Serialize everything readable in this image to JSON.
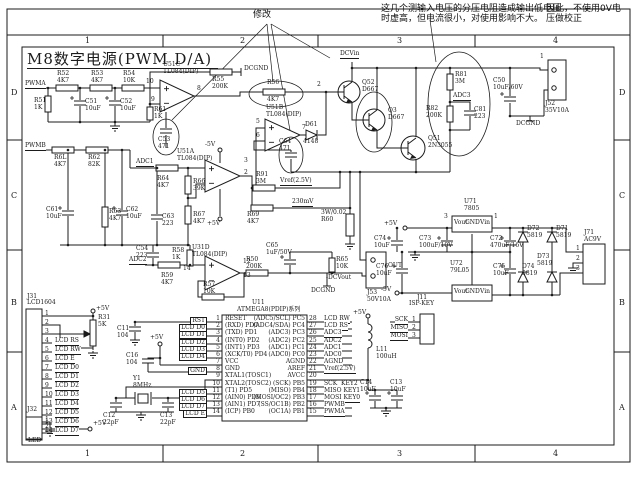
{
  "title": "M8数字电源(PWM D/A)",
  "frame": {
    "columns": [
      "1",
      "2",
      "3",
      "4"
    ],
    "rows": [
      "D",
      "C",
      "B",
      "A"
    ]
  },
  "notes": {
    "revision_mark": "修改",
    "note_line1": "这几个测输入电压的分压电阻造成输出低电压",
    "note_line2": "时虚高，但电流很小，对使用影响不大。",
    "note_right_line1": "因此，不使用0V电",
    "note_right_line2": "压做校正"
  },
  "components": [
    {
      "r": "R52",
      "v": "4K7",
      "x": 57,
      "y": 71
    },
    {
      "r": "R53",
      "v": "4K7",
      "x": 91,
      "y": 71
    },
    {
      "r": "R54",
      "v": "10K",
      "x": 123,
      "y": 71
    },
    {
      "r": "R51",
      "v": "1K",
      "x": 34,
      "y": 98
    },
    {
      "r": "C51",
      "v": "10uF",
      "x": 85,
      "y": 99
    },
    {
      "r": "C52",
      "v": "10uF",
      "x": 120,
      "y": 99
    },
    {
      "r": "R61",
      "v": "1K",
      "x": 154,
      "y": 107
    },
    {
      "r": "R55",
      "v": "200K",
      "x": 212,
      "y": 77
    },
    {
      "r": "U51C",
      "v": "TL084(DIP)",
      "x": 163,
      "y": 62
    },
    {
      "r": "U51B",
      "v": "TL084(DIP)",
      "x": 266,
      "y": 105
    },
    {
      "r": "C53",
      "v": "471",
      "x": 158,
      "y": 137
    },
    {
      "r": "C64",
      "v": "471",
      "x": 279,
      "y": 139
    },
    {
      "r": "Q52",
      "v": "D667",
      "x": 362,
      "y": 80
    },
    {
      "r": "Q3",
      "v": "D667",
      "x": 388,
      "y": 108
    },
    {
      "r": "Q51",
      "v": "2N3055",
      "x": 428,
      "y": 136
    },
    {
      "r": "R81",
      "v": "3M",
      "x": 455,
      "y": 72
    },
    {
      "r": "R82",
      "v": "200K",
      "x": 426,
      "y": 106
    },
    {
      "r": "C81",
      "v": "223",
      "x": 474,
      "y": 107
    },
    {
      "r": "C50",
      "v": "10uF/60V",
      "x": 493,
      "y": 78
    },
    {
      "r": "J52",
      "v": "35V10A",
      "x": 545,
      "y": 101
    },
    {
      "r": "R6L",
      "v": "4K7",
      "x": 54,
      "y": 155
    },
    {
      "r": "R62",
      "v": "82K",
      "x": 88,
      "y": 155
    },
    {
      "r": "C61",
      "v": "10uF",
      "x": 46,
      "y": 207
    },
    {
      "r": "R63",
      "v": "4K7",
      "x": 109,
      "y": 209
    },
    {
      "r": "C62",
      "v": "10uF",
      "x": 126,
      "y": 207
    },
    {
      "r": "U51A",
      "v": "TL084(DIP)",
      "x": 177,
      "y": 149
    },
    {
      "r": "R64",
      "v": "4K7",
      "x": 157,
      "y": 176
    },
    {
      "r": "R66",
      "v": "39K",
      "x": 193,
      "y": 179
    },
    {
      "r": "C63",
      "v": "223",
      "x": 162,
      "y": 214
    },
    {
      "r": "R67",
      "v": "4K7",
      "x": 193,
      "y": 212
    },
    {
      "r": "R91",
      "v": "3M",
      "x": 256,
      "y": 172
    },
    {
      "r": "R69",
      "v": "4K7",
      "x": 247,
      "y": 212
    },
    {
      "r": "C54",
      "v": "223",
      "x": 136,
      "y": 246
    },
    {
      "r": "R58",
      "v": "1K",
      "x": 172,
      "y": 248
    },
    {
      "r": "R59",
      "v": "4K7",
      "x": 161,
      "y": 273
    },
    {
      "r": "U31D",
      "v": "TL084(DIP)",
      "x": 192,
      "y": 245
    },
    {
      "r": "R57",
      "v": "10K",
      "x": 203,
      "y": 282
    },
    {
      "r": "R50",
      "v": "200K",
      "x": 246,
      "y": 257
    },
    {
      "r": "C65",
      "v": "1uF/50V",
      "x": 266,
      "y": 243
    },
    {
      "r": "R65",
      "v": "10K",
      "x": 336,
      "y": 257
    },
    {
      "r": "3W/0.02",
      "v": "R60",
      "x": 321,
      "y": 210
    },
    {
      "r": "J53",
      "v": "50V10A",
      "x": 367,
      "y": 290
    },
    {
      "r": "U71",
      "v": "7805",
      "x": 464,
      "y": 199
    },
    {
      "r": "U72",
      "v": "79L05",
      "x": 450,
      "y": 261
    },
    {
      "r": "C74",
      "v": "10uF",
      "x": 374,
      "y": 236
    },
    {
      "r": "C73",
      "v": "100uF/10V",
      "x": 419,
      "y": 236
    },
    {
      "r": "C72",
      "v": "470uF/16V",
      "x": 490,
      "y": 236
    },
    {
      "r": "C76",
      "v": "10uF",
      "x": 376,
      "y": 264
    },
    {
      "r": "C75",
      "v": "10uF",
      "x": 493,
      "y": 264
    },
    {
      "r": "D72",
      "v": "5819",
      "x": 527,
      "y": 226
    },
    {
      "r": "D71",
      "v": "5819",
      "x": 556,
      "y": 226
    },
    {
      "r": "D73",
      "v": "5819",
      "x": 537,
      "y": 254
    },
    {
      "r": "D74",
      "v": "5819",
      "x": 522,
      "y": 264
    },
    {
      "r": "J71",
      "v": "AC9V",
      "x": 584,
      "y": 230
    },
    {
      "r": "Y1",
      "v": "8MHz",
      "x": 133,
      "y": 376
    },
    {
      "r": "C12",
      "v": "22pF",
      "x": 103,
      "y": 413
    },
    {
      "r": "C13",
      "v": "22pF",
      "x": 160,
      "y": 413
    },
    {
      "r": "C11",
      "v": "104",
      "x": 117,
      "y": 326
    },
    {
      "r": "C16",
      "v": "104",
      "x": 126,
      "y": 353
    },
    {
      "r": "R31",
      "v": "5K",
      "x": 98,
      "y": 315
    },
    {
      "r": "R32",
      "v": "10",
      "x": 64,
      "y": 409
    },
    {
      "r": "L11",
      "v": "100uH",
      "x": 376,
      "y": 347
    },
    {
      "r": "C14",
      "v": "10uF",
      "x": 360,
      "y": 380
    },
    {
      "r": "C13",
      "v": "10uF",
      "x": 390,
      "y": 380
    }
  ],
  "net_labels": [
    {
      "t": "PWMA",
      "x": 25,
      "y": 81,
      "u": 1
    },
    {
      "t": "PWMB",
      "x": 25,
      "y": 143,
      "u": 1
    },
    {
      "t": "DCGND",
      "x": 244,
      "y": 66
    },
    {
      "t": "10",
      "x": 146,
      "y": 79
    },
    {
      "t": "9",
      "x": 151,
      "y": 97
    },
    {
      "t": "8",
      "x": 197,
      "y": 86
    },
    {
      "t": "R56",
      "x": 267,
      "y": 80
    },
    {
      "t": "4K7",
      "x": 267,
      "y": 97
    },
    {
      "t": "2",
      "x": 317,
      "y": 82
    },
    {
      "t": "5",
      "x": 256,
      "y": 119
    },
    {
      "t": "6",
      "x": 256,
      "y": 133
    },
    {
      "t": "7",
      "x": 302,
      "y": 125
    },
    {
      "t": "D61",
      "x": 305,
      "y": 122
    },
    {
      "t": "4148",
      "x": 303,
      "y": 139
    },
    {
      "t": "DCVin",
      "x": 340,
      "y": 51,
      "u": 1
    },
    {
      "t": "ADC3",
      "x": 453,
      "y": 93,
      "u": 1
    },
    {
      "t": "1",
      "x": 540,
      "y": 54
    },
    {
      "t": "DCGND",
      "x": 516,
      "y": 121
    },
    {
      "t": "ADC1",
      "x": 136,
      "y": 159,
      "u": 1
    },
    {
      "t": "-5V",
      "x": 205,
      "y": 142
    },
    {
      "t": "+5V",
      "x": 207,
      "y": 221
    },
    {
      "t": "3",
      "x": 244,
      "y": 158
    },
    {
      "t": "2",
      "x": 244,
      "y": 170
    },
    {
      "t": "Vref(2.5V)",
      "x": 280,
      "y": 178,
      "u": 1
    },
    {
      "t": "230mV",
      "x": 292,
      "y": 199,
      "u": 1
    },
    {
      "t": "ADC2",
      "x": 129,
      "y": 257,
      "u": 1
    },
    {
      "t": "12",
      "x": 243,
      "y": 259
    },
    {
      "t": "13",
      "x": 243,
      "y": 273
    },
    {
      "t": "14",
      "x": 183,
      "y": 266
    },
    {
      "t": "OUT",
      "x": 388,
      "y": 263
    },
    {
      "t": "-DCVout",
      "x": 326,
      "y": 275
    },
    {
      "t": "DCGND",
      "x": 311,
      "y": 288
    },
    {
      "t": "+5V",
      "x": 384,
      "y": 221
    },
    {
      "t": "3",
      "x": 444,
      "y": 214
    },
    {
      "t": "1",
      "x": 494,
      "y": 214
    },
    {
      "t": "-5V",
      "x": 381,
      "y": 287
    },
    {
      "t": "1",
      "x": 576,
      "y": 246
    },
    {
      "t": "2",
      "x": 576,
      "y": 256
    },
    {
      "t": "3",
      "x": 576,
      "y": 266
    },
    {
      "t": "Vout",
      "x": 454,
      "y": 220
    },
    {
      "t": "GND",
      "x": 465,
      "y": 220
    },
    {
      "t": "Vin",
      "x": 480,
      "y": 220
    },
    {
      "t": "Vout",
      "x": 454,
      "y": 289
    },
    {
      "t": "GND",
      "x": 465,
      "y": 289
    },
    {
      "t": "Vin",
      "x": 480,
      "y": 289
    },
    {
      "t": "+5V",
      "x": 150,
      "y": 335
    },
    {
      "t": "+5V",
      "x": 96,
      "y": 306
    },
    {
      "t": "+5V",
      "x": 93,
      "y": 421
    },
    {
      "t": "+5V",
      "x": 353,
      "y": 310
    }
  ],
  "mcu": {
    "ref": "U11",
    "part": "ATMEGA8(PDIP)系列",
    "rows": [
      {
        "ll": "RST",
        "lp": "1",
        "l": "RESET",
        "r": "(ADC5/SCL) PC5",
        "rp": "28",
        "rl": "LCD RW"
      },
      {
        "ll": "LCD D0",
        "lp": "2",
        "l": "(RXD) PD0",
        "r": "(ADC4/SDA) PC4",
        "rp": "27",
        "rl": "LCD RS"
      },
      {
        "ll": "LCD D1",
        "lp": "3",
        "l": "(TXD) PD1",
        "r": "(ADC3) PC3",
        "rp": "26",
        "rl": "ADC3"
      },
      {
        "ll": "LCD D2",
        "lp": "4",
        "l": "(INT0) PD2",
        "r": "(ADC2) PC2",
        "rp": "25",
        "rl": "ADC2"
      },
      {
        "ll": "LCD D3",
        "lp": "5",
        "l": "(INT1) PD3",
        "r": "(ADC1) PC1",
        "rp": "24",
        "rl": "ADC1"
      },
      {
        "ll": "LCD D4",
        "lp": "6",
        "l": "(XCK/T0) PD4",
        "r": "(ADC0) PC0",
        "rp": "23",
        "rl": "ADC0"
      },
      {
        "ll": "",
        "lp": "7",
        "l": "VCC",
        "r": "AGND",
        "rp": "22",
        "rl": "AGND"
      },
      {
        "ll": "GND",
        "lp": "8",
        "l": "GND",
        "r": "AREF",
        "rp": "21",
        "rl": "Vref(2.5V)"
      },
      {
        "ll": "",
        "lp": "9",
        "l": "XTAL1(TOSC1)",
        "r": "AVCC",
        "rp": "20",
        "rl": ""
      },
      {
        "ll": "",
        "lp": "10",
        "l": "XTAL2(TOSC2)",
        "r": "(SCK) PB5",
        "rp": "19",
        "rl": "SCK  KEY2"
      },
      {
        "ll": "LCD D5",
        "lp": "11",
        "l": "(T1) PD5",
        "r": "(MISO) PB4",
        "rp": "18",
        "rl": "MISO KEY1"
      },
      {
        "ll": "LCD D6",
        "lp": "12",
        "l": "(AIN0) PD6",
        "r": "(MOSI/OC2) PB3",
        "rp": "17",
        "rl": "MOSI KEY0"
      },
      {
        "ll": "LCD D7",
        "lp": "13",
        "l": "(AIN1) PD7",
        "r": "(SS/OC1B) PB2",
        "rp": "16",
        "rl": "PWMB"
      },
      {
        "ll": "LCD E",
        "lp": "14",
        "l": "(ICP) PB0",
        "r": "(OC1A) PB1",
        "rp": "15",
        "rl": "PWMA"
      }
    ]
  },
  "lcd_connector": {
    "ref": "J31",
    "part": "LCD1604",
    "pins": [
      {
        "n": "1",
        "t": ""
      },
      {
        "n": "2",
        "t": ""
      },
      {
        "n": "3",
        "t": ""
      },
      {
        "n": "4",
        "t": "LCD RS"
      },
      {
        "n": "5",
        "t": "LCD RW"
      },
      {
        "n": "6",
        "t": "LCD E"
      },
      {
        "n": "7",
        "t": "LCD D0"
      },
      {
        "n": "8",
        "t": "LCD D1"
      },
      {
        "n": "9",
        "t": "LCD D2"
      },
      {
        "n": "10",
        "t": "LCD D3"
      },
      {
        "n": "11",
        "t": "LCD D4"
      },
      {
        "n": "12",
        "t": "LCD D5"
      },
      {
        "n": "13",
        "t": "LCD D6"
      },
      {
        "n": "14",
        "t": "LCD D7"
      }
    ]
  },
  "isp_connector": {
    "ref": "J11",
    "part": "ISP-KEY",
    "pins": [
      {
        "n": "1",
        "t": "SCK"
      },
      {
        "n": "2",
        "t": "MISO"
      },
      {
        "n": "3",
        "t": "MOSI"
      }
    ]
  },
  "led_connector": {
    "ref": "J32",
    "tag": "LED",
    "pins": [
      {
        "n": "1"
      },
      {
        "n": "2"
      }
    ]
  },
  "colors": {
    "ink": "#1b1b1b",
    "paper": "#ffffff"
  }
}
